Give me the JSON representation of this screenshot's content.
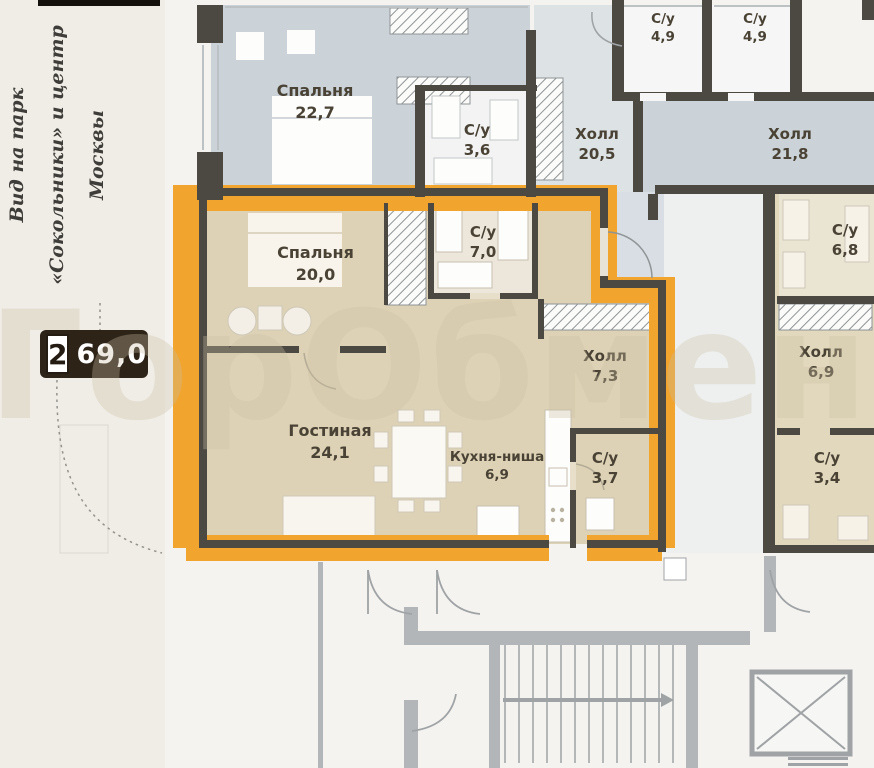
{
  "watermark": "ГорОбмен",
  "side_note": {
    "line1": "Вид",
    "line2": "на парк «Сокольники»",
    "line3": "и центр Москвы"
  },
  "badge": {
    "rooms": "2",
    "area": "69,0"
  },
  "apartment": {
    "rooms": [
      {
        "label": "Спальня",
        "area": "20,0"
      },
      {
        "label": "С/у",
        "area": "7,0"
      },
      {
        "label": "Холл",
        "area": "7,3"
      },
      {
        "label": "Гостиная",
        "area": "24,1"
      },
      {
        "label": "Кухня-ниша",
        "area": "6,9"
      },
      {
        "label": "С/у",
        "area": "3,7"
      }
    ]
  },
  "neighbor_rooms": [
    {
      "label": "Спальня",
      "area": "22,7"
    },
    {
      "label": "С/у",
      "area": "3,6"
    },
    {
      "label": "Холл",
      "area": "20,5"
    },
    {
      "label": "С/у",
      "area": "4,9"
    },
    {
      "label": "С/у",
      "area": "4,9"
    },
    {
      "label": "Холл",
      "area": "21,8"
    },
    {
      "label": "С/у",
      "area": "6,8"
    },
    {
      "label": "Холл",
      "area": "6,9"
    },
    {
      "label": "С/у",
      "area": "3,4"
    }
  ],
  "colors": {
    "highlight_orange": "#F1A42E",
    "wall_dark": "#4C4943",
    "room_blue": "#CBD2D8",
    "room_beige": "#DDD2B5",
    "badge_bg": "#2D2317",
    "common_wall_gray": "#9FA3A5"
  }
}
